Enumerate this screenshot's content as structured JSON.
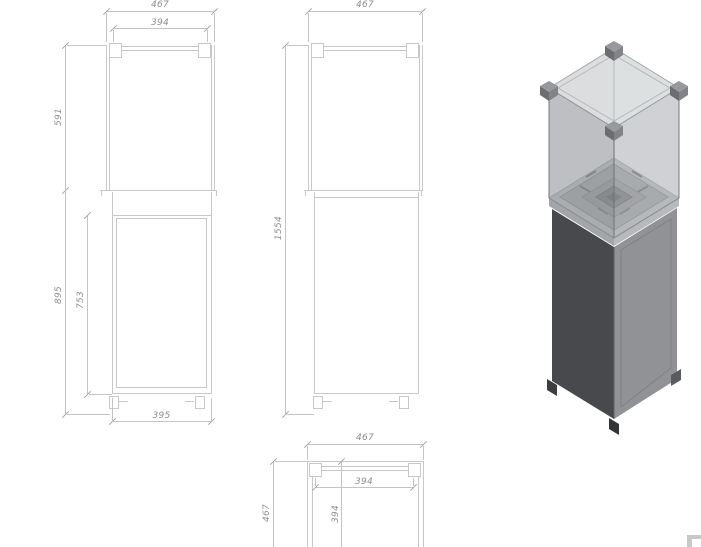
{
  "drawing": {
    "front_view": {
      "width_outer": "467",
      "width_inner": "394",
      "height_upper": "591",
      "height_lower": "895",
      "door_height": "753",
      "base_width": "395"
    },
    "side_view": {
      "width_outer": "467",
      "height_total": "1554"
    },
    "top_view": {
      "width_outer": "467",
      "width_inner": "394",
      "depth_outer": "467",
      "depth_inner": "394"
    }
  },
  "colors": {
    "background": "#ffffff",
    "drawing_line": "#c6c8ca",
    "dimension_line": "#c2c4c6",
    "tick": "#9fa2a4",
    "dimension_text": "#8b8e90",
    "render_dark_face": "#48494c",
    "render_light_face": "#909296",
    "render_plate": "#c6c8ca",
    "watermark": "#c6c8ca"
  }
}
